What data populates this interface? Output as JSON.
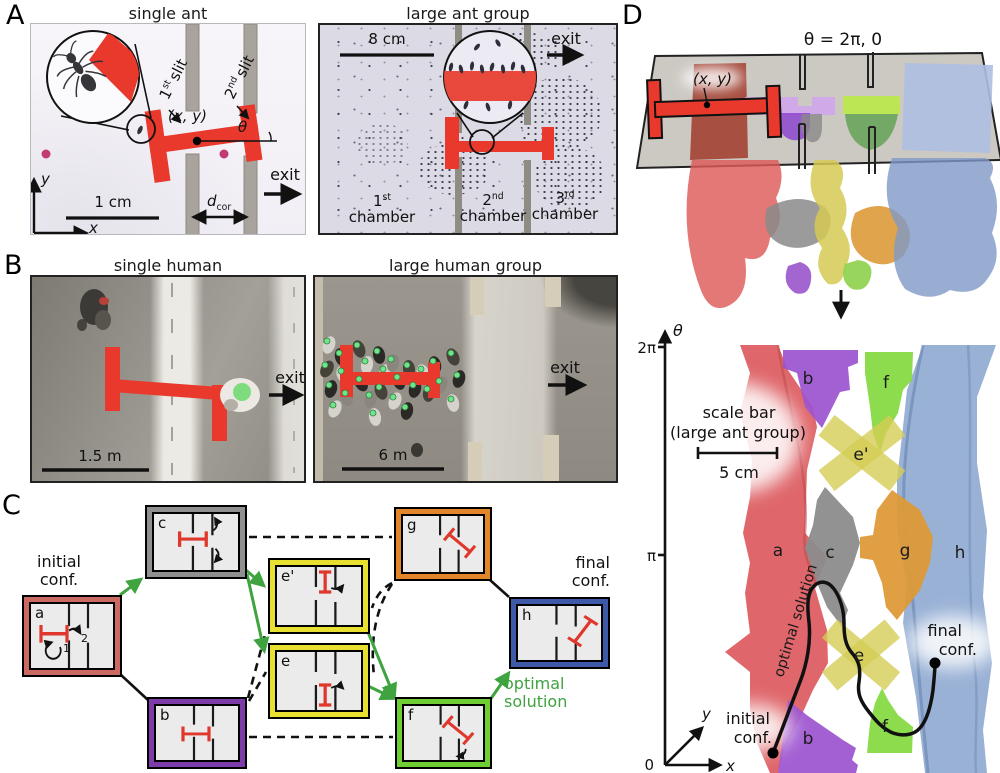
{
  "panelA": {
    "label": "A",
    "left": {
      "title": "single ant",
      "slit1": {
        "num": "1",
        "sup": "st",
        "word": "slit"
      },
      "slit2": {
        "num": "2",
        "sup": "nd",
        "word": "slit"
      },
      "xy": "(x, y)",
      "theta": "θ",
      "exit": "exit",
      "scale": "1 cm",
      "dcor": {
        "base": "d",
        "sub": "cor"
      },
      "axis_x": "x",
      "axis_y": "y"
    },
    "right": {
      "title": "large ant group",
      "scale": "8 cm",
      "exit": "exit",
      "chambers": [
        {
          "num": "1",
          "sup": "st",
          "word": "chamber"
        },
        {
          "num": "2",
          "sup": "nd",
          "word": "chamber"
        },
        {
          "num": "3",
          "sup": "rd",
          "word": "chamber"
        }
      ]
    }
  },
  "panelB": {
    "label": "B",
    "left": {
      "title": "single human",
      "scale": "1.5 m",
      "exit": "exit"
    },
    "right": {
      "title": "large human group",
      "scale": "6 m",
      "exit": "exit"
    }
  },
  "panelC": {
    "label": "C",
    "initial_conf": {
      "line1": "initial",
      "line2": "conf."
    },
    "final_conf": {
      "line1": "final",
      "line2": "conf."
    },
    "optimal": {
      "line1": "optimal",
      "line2": "solution"
    },
    "nodes": {
      "a": "a",
      "b": "b",
      "c": "c",
      "e": "e",
      "eprime": "e'",
      "f": "f",
      "g": "g",
      "h": "h"
    },
    "step1": "1",
    "step2": "2"
  },
  "panelD": {
    "label": "D",
    "theta_equation": "θ = 2π, 0",
    "xy": "(x, y)",
    "axis": {
      "theta": "θ",
      "two_pi": "2π",
      "pi": "π",
      "zero": "0",
      "x": "x",
      "y": "y"
    },
    "scalebar": {
      "line1": "scale bar",
      "line2": "(large ant group)",
      "value": "5 cm"
    },
    "optimal": "optimal solution",
    "initial_conf": {
      "line1": "initial",
      "line2": "conf."
    },
    "final_conf": {
      "line1": "final",
      "line2": "conf."
    },
    "regions": {
      "a": "a",
      "b": "b",
      "c": "c",
      "e": "e",
      "eprime": "e'",
      "f": "f",
      "g": "g",
      "h": "h"
    }
  },
  "colors": {
    "load_red": "#e8392c",
    "arrow_green": "#3fa33f",
    "node_border": {
      "a": "#cb6a63",
      "b": "#7d3ca9",
      "c": "#8f8f8f",
      "e": "#e8e030",
      "f": "#6fce33",
      "g": "#e2862b",
      "h": "#3d59a7"
    },
    "region_fill": {
      "a": "#dc5a5e",
      "b": "#9b53cf",
      "c": "#8c8c8c",
      "e": "#d5cd55",
      "f": "#82d93e",
      "g": "#dd9a38",
      "h": "#8ba6cf"
    }
  }
}
